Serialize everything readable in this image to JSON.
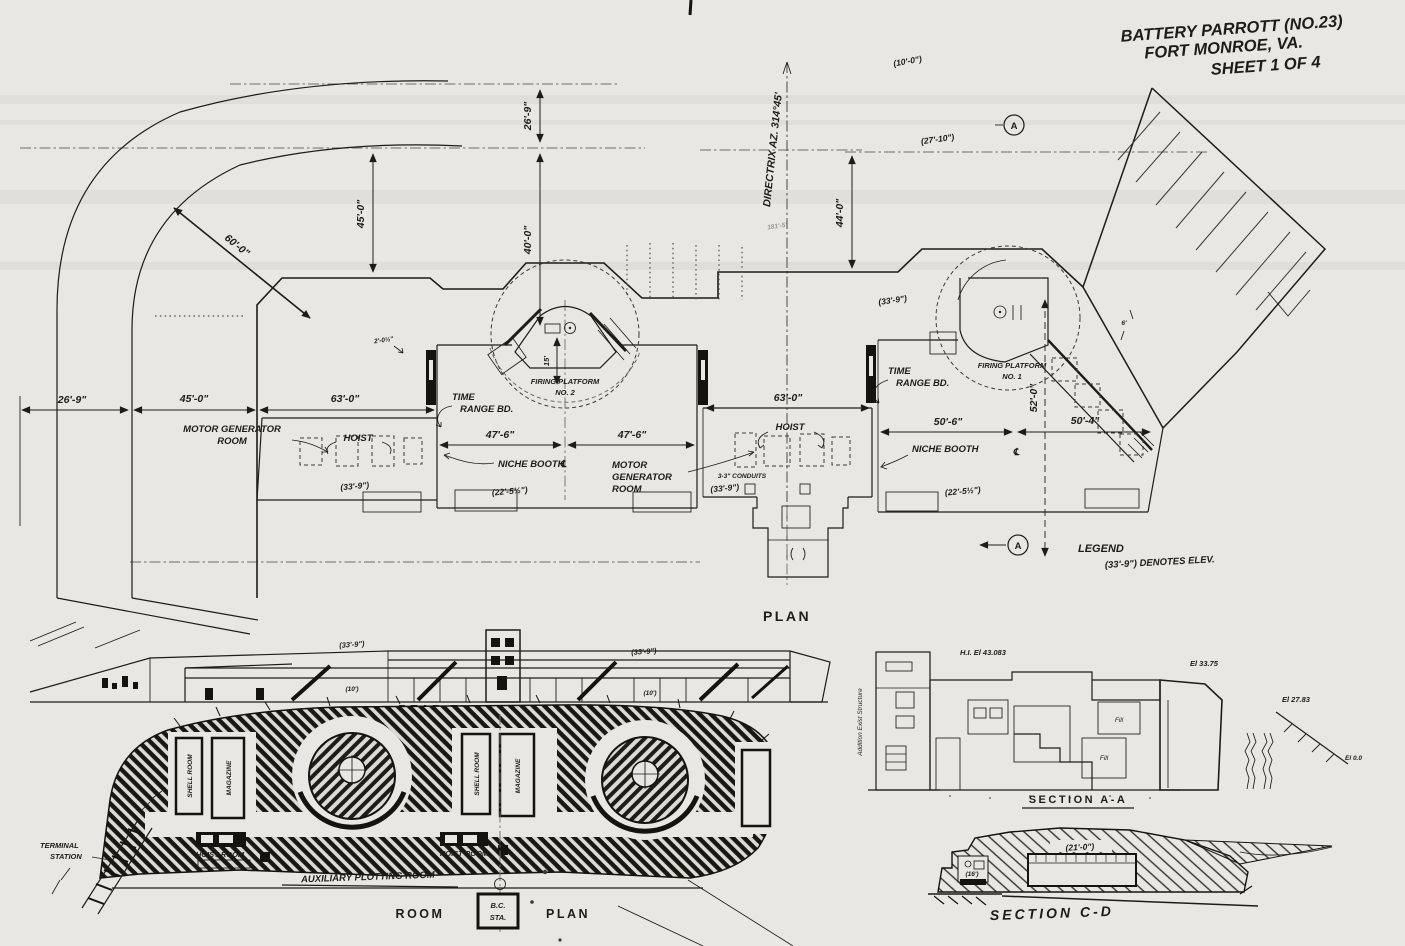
{
  "title": {
    "line1": "BATTERY PARROTT (NO.23)",
    "line2": "FORT MONROE, VA.",
    "line3": "SHEET 1 OF 4"
  },
  "plan": {
    "caption": "PLAN",
    "directrix": "DIRECTRIX AZ. 314°45'",
    "marker_a": "A",
    "legend_title": "LEGEND",
    "legend_entry": "(33'-9\") DENOTES ELEV.",
    "centerline": "℄",
    "dims": {
      "v26_9": "26'-9\"",
      "v40_0": "40'-0\"",
      "v15": "15'",
      "v45_0": "45'-0\"",
      "d60_0": "60'-0\"",
      "v44_0": "44'-0\"",
      "h26_9": "26'-9\"",
      "h45_0": "45'-0\"",
      "h63_0_l": "63'-0\"",
      "h63_0_r": "63'-0\"",
      "h47_6_a": "47'-6\"",
      "h47_6_b": "47'-6\"",
      "h50_6": "50'-6\"",
      "h50_4": "50'-4\"",
      "v52_0": "52'-0\"",
      "p10_0": "(10'-0\")",
      "p27_10": "(27'-10\")",
      "p33_9_a": "(33'-9\")",
      "p33_9_b": "(33'-9\")",
      "p33_9_c": "(33'-9\")",
      "p22_5_a": "(22'-5½\")",
      "p22_5_b": "(22'-5½\")",
      "p2_0": "2'-0½\"",
      "faint_181": "181'-5\"",
      "p6": "6'",
      "conduits": "3-3\" CONDUITS"
    },
    "labels": {
      "time_range_1a": "TIME",
      "time_range_1b": "RANGE BD.",
      "time_range_2a": "TIME",
      "time_range_2b": "RANGE BD.",
      "fp2a": "FIRING PLATFORM",
      "fp2b": "NO. 2",
      "fp1a": "FIRING PLATFORM",
      "fp1b": "NO. 1",
      "mgr1a": "MOTOR GENERATOR",
      "mgr1b": "ROOM",
      "mgr2a": "MOTOR",
      "mgr2b": "GENERATOR",
      "mgr2c": "ROOM",
      "hoist1": "HOIST",
      "hoist2": "HOIST",
      "niche1": "NICHE BOOTH",
      "niche2": "NICHE BOOTH"
    }
  },
  "rear_elevation": {
    "caption": "REAR ELEVATION",
    "p33_9_a": "(33'-9\")",
    "p33_9_b": "(33'-9\")",
    "p10_a": "(10')",
    "p10_b": "(10')"
  },
  "room_plan": {
    "caption_room": "ROOM",
    "caption_plan": "PLAN",
    "bc1": "B.C.",
    "bc2": "STA.",
    "terminal1": "TERMINAL",
    "terminal2": "STATION",
    "shell1": "SHELL ROOM",
    "mag1": "MAGAZINE",
    "shell2": "SHELL ROOM",
    "mag2": "MAGAZINE",
    "hoist1": "HOIST ROOM",
    "hoist2": "HOIST ROOM",
    "aux": "AUXILIARY PLOTTING ROOM"
  },
  "section_aa": {
    "caption": "SECTION A-A",
    "el_top": "H.I. El 43.083",
    "el_mid": "El 33.75",
    "el_right": "El 27.83",
    "el_base": "El 0.0",
    "fill1": "Fill",
    "fill2": "Fill",
    "side_note": "Addition   Exist Structure"
  },
  "section_cd": {
    "caption": "SECTION C-D",
    "p21_0": "(21'-0\")",
    "p16": "(16')"
  }
}
